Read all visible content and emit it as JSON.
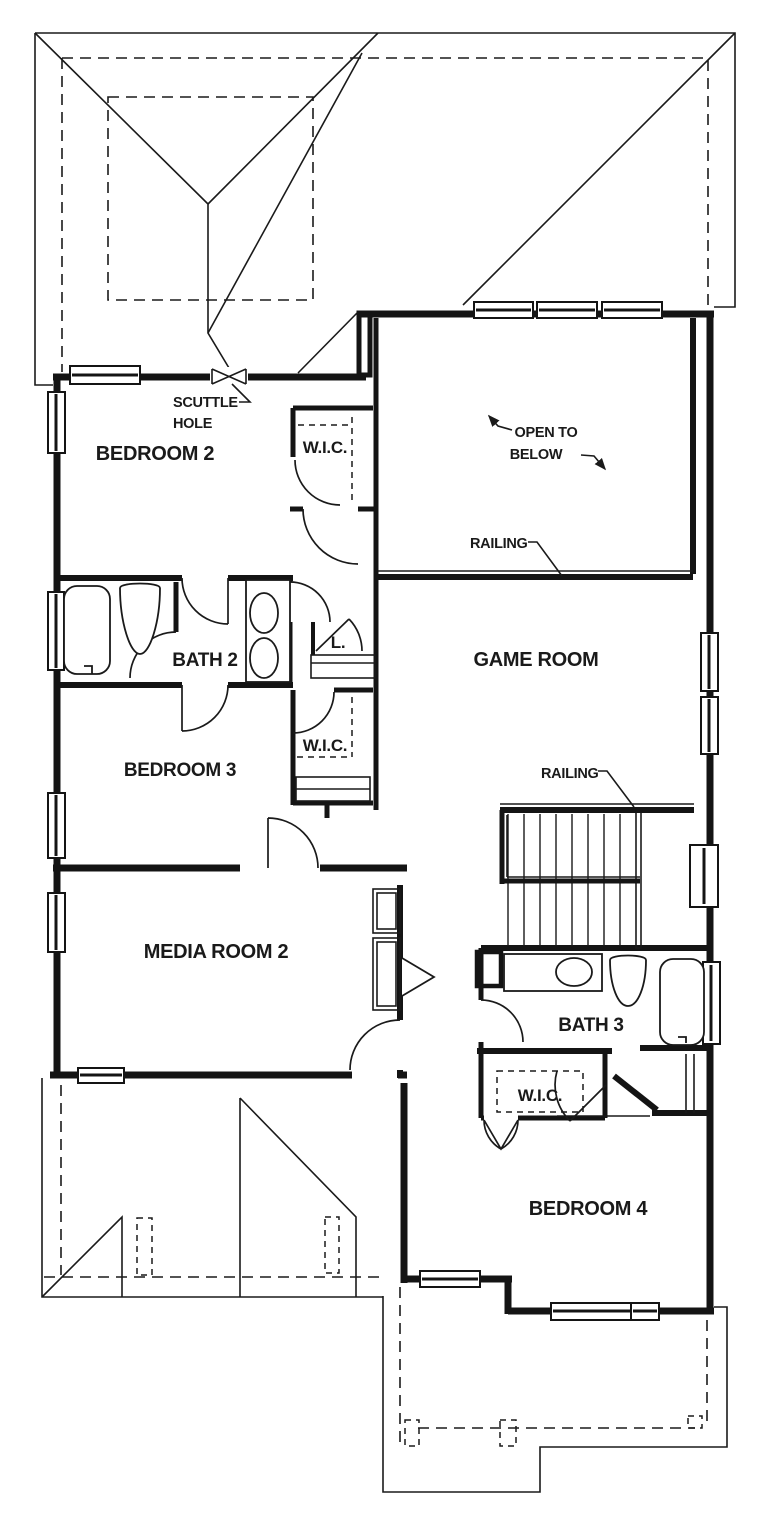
{
  "drawing_title": "Second Floor Plan",
  "colors": {
    "ink": "#1a1a1a",
    "paper": "#ffffff"
  },
  "rooms": {
    "bedroom2": {
      "label": "BEDROOM 2"
    },
    "bedroom2_closet": {
      "label": "W.I.C."
    },
    "bath2": {
      "label": "BATH 2"
    },
    "linen_closet": {
      "label": "L."
    },
    "bedroom3": {
      "label": "BEDROOM 3"
    },
    "bedroom3_closet": {
      "label": "W.I.C."
    },
    "game_room": {
      "label": "GAME ROOM"
    },
    "media_room2": {
      "label": "MEDIA ROOM 2"
    },
    "bath3": {
      "label": "BATH 3"
    },
    "bedroom4_closet": {
      "label": "W.I.C."
    },
    "bedroom4": {
      "label": "BEDROOM 4"
    }
  },
  "annotations": {
    "scuttle_line1": "SCUTTLE",
    "scuttle_line2": "HOLE",
    "open_below_line1": "OPEN  TO",
    "open_below_line2": "BELOW",
    "railing_open_below": "RAILING",
    "railing_stairs": "RAILING"
  }
}
